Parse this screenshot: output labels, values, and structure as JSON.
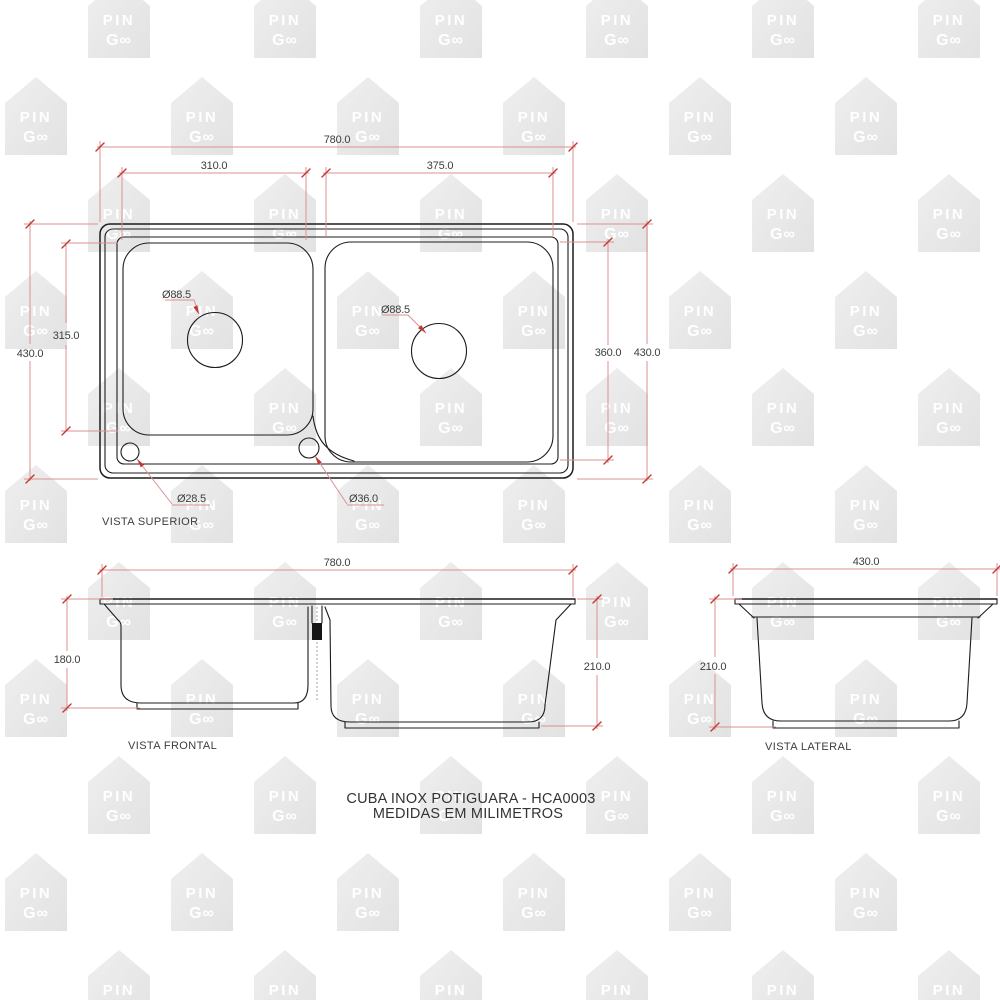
{
  "background": "#ffffff",
  "watermark": {
    "line1": "PIN",
    "line2": "G∞"
  },
  "title": {
    "line1": "CUBA INOX POTIGUARA - HCA0003",
    "line2": "MEDIDAS EM MILIMETROS"
  },
  "views": {
    "superior": {
      "label": "VISTA SUPERIOR",
      "overall_width": "780.0",
      "left_bowl_width": "310.0",
      "right_bowl_width": "375.0",
      "overall_depth_left": "430.0",
      "left_bowl_depth": "315.0",
      "right_bowl_depth": "360.0",
      "overall_depth_right": "430.0",
      "left_drain": "Ø88.5",
      "right_drain": "Ø88.5",
      "corner_hole": "Ø28.5",
      "center_hole": "Ø36.0"
    },
    "frontal": {
      "label": "VISTA FRONTAL",
      "overall_width": "780.0",
      "left_bowl_height": "180.0",
      "right_bowl_height": "210.0"
    },
    "lateral": {
      "label": "VISTA LATERAL",
      "overall_width": "430.0",
      "bowl_height": "210.0"
    }
  },
  "colors": {
    "dim_line": "#dd9090",
    "dim_tick": "#bf3a32",
    "dim_text": "#3d3d3d",
    "draw_line": "#1c1c1c",
    "watermark_fill": "#e7e7e7",
    "watermark_text": "#ffffff"
  }
}
